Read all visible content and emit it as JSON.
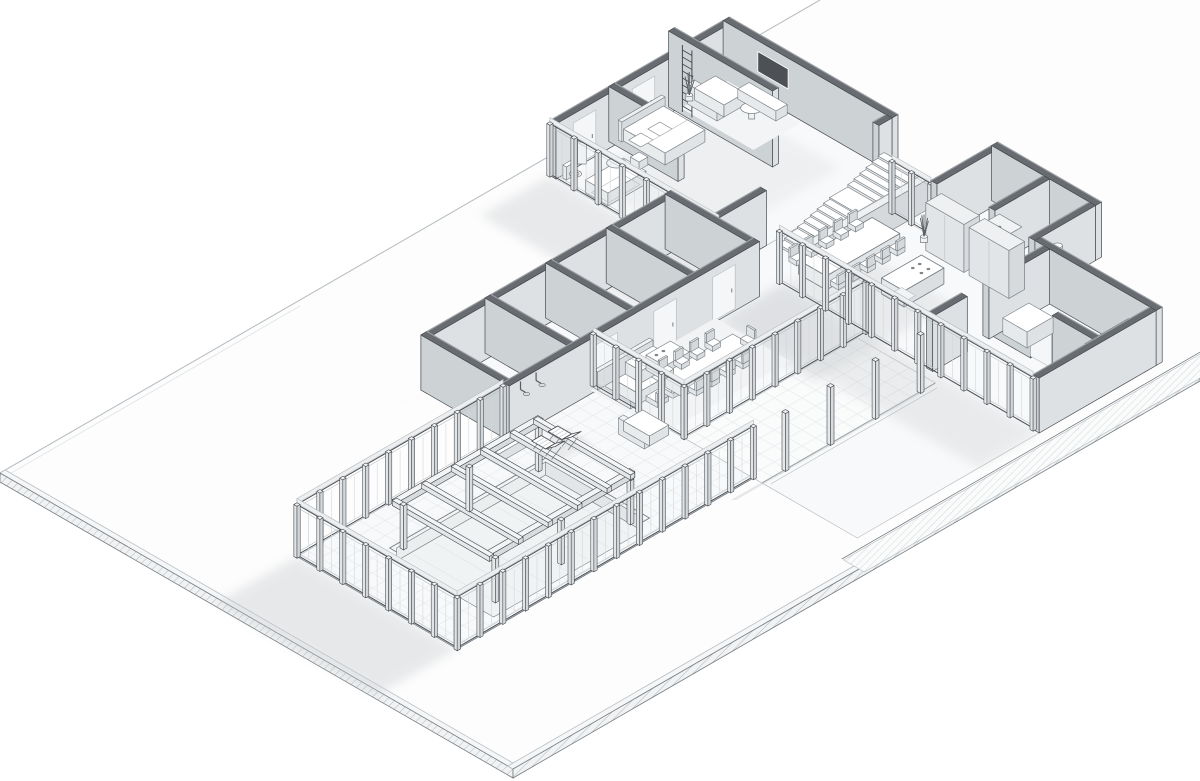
{
  "scene": {
    "kind": "architectural-axonometric-cutaway",
    "subject": "Single-storey L-shaped modern residence with indoor pool wing, shown as a monochrome isometric cutaway on a rectangular site slab",
    "style": "grayscale line render, walls cut at mid-height with dark caps, soft shadows cast to the lower left",
    "visible_text": ""
  },
  "palette": {
    "background": "#ffffff",
    "line_dark": "#45494e",
    "line_mid": "#767d82",
    "line_light": "#b9bfc3",
    "wall_cap": "#686c70",
    "wall_cap_light": "#9ca1a5",
    "wall_face_light": "#eef0f1",
    "wall_face_mid": "#dde1e3",
    "wall_face_shade": "#cdd2d5",
    "floor": "#f8f9fa",
    "tile_grid": "#e4e7e9",
    "shadow": "#c7cbcf",
    "glass_post": "#e8ebec",
    "fascia": "#eceef0",
    "tv_screen": "#4d5155",
    "hatch": "#aeb4b8",
    "pool_wall": "#e2e6e8",
    "furniture_fill": "#f4f5f6",
    "white": "#ffffff"
  },
  "site": {
    "plot": "large rectangular ground slab seen in isometric",
    "edge_treatment": "thin hatched border slabs on south-west and south-east edges",
    "walkway": "hatched footpath running along the east wing",
    "shadows_direction": "lower-left"
  },
  "house": {
    "zones": [
      {
        "name": "master-suite",
        "items": [
          "glass end wall",
          "bed",
          "headboard",
          "pillows",
          "wall ladder",
          "tall feature wall",
          "toilet",
          "pedestal basin",
          "bathtub",
          "egg chair",
          "lounge sofa",
          "round side table",
          "wall tv",
          "media console",
          "potted plant"
        ]
      },
      {
        "name": "wardrobe-block",
        "rooms": 3,
        "items": [
          "three doored storage rooms",
          "spa shower room with 2 shower heads",
          "bench"
        ]
      },
      {
        "name": "stairs",
        "flights": 2,
        "treads_per_flight": [
          6,
          8
        ],
        "items": [
          "landing",
          "rail wall"
        ]
      },
      {
        "name": "kitchen-dining",
        "items": [
          "kitchen island with cooktop and sink",
          "dining table",
          "dining chairs"
        ],
        "dining_chairs": 10,
        "tall_cabinets": 2,
        "plants": 1
      },
      {
        "name": "family-zone",
        "items": [
          "rug",
          "l-sofa",
          "armchairs",
          "coffee table",
          "second island",
          "long table",
          "chairs"
        ],
        "armchairs": 2,
        "table_chairs": 9
      },
      {
        "name": "utility-wing",
        "items": [
          "bathroom with toilet and cylindrical basin",
          "shower room",
          "wardrobe cabinet",
          "doored store rooms"
        ]
      },
      {
        "name": "pool-wing",
        "items": [
          "sunken pool",
          "pergola frame",
          "sun loungers",
          "outdoor sofa",
          "bench",
          "glass perimeter walls"
        ],
        "sun_loungers": 2,
        "pergola_cross_beams": 6
      },
      {
        "name": "terrace",
        "items": [
          "paved terrace",
          "step edge",
          "free-standing posts"
        ],
        "posts": 4
      }
    ]
  }
}
